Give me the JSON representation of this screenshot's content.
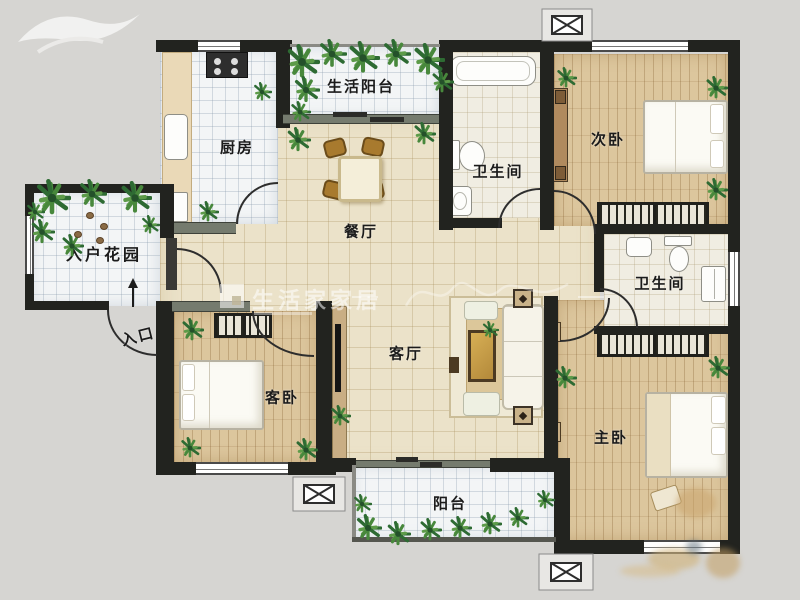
{
  "labels": {
    "entry_garden": "入户花园",
    "entrance": "入口",
    "kitchen": "厨房",
    "service_balcony": "生活阳台",
    "bath_top": "卫生间",
    "bedroom_second": "次卧",
    "dining": "餐厅",
    "living": "客厅",
    "bath_right": "卫生间",
    "guest_bedroom": "客卧",
    "master_bedroom": "主卧",
    "balcony": "阳台"
  },
  "watermark": {
    "brand": "生活家家居"
  },
  "colors": {
    "wall": "#22231f",
    "partition": "#757b6e",
    "wood_floor": "#dcc69d",
    "beige_tile": "#ebe2c9",
    "white_tile": "#f3f5f6",
    "plant_green": "#3d7a3c",
    "furniture_gold": "#c9a24a"
  }
}
